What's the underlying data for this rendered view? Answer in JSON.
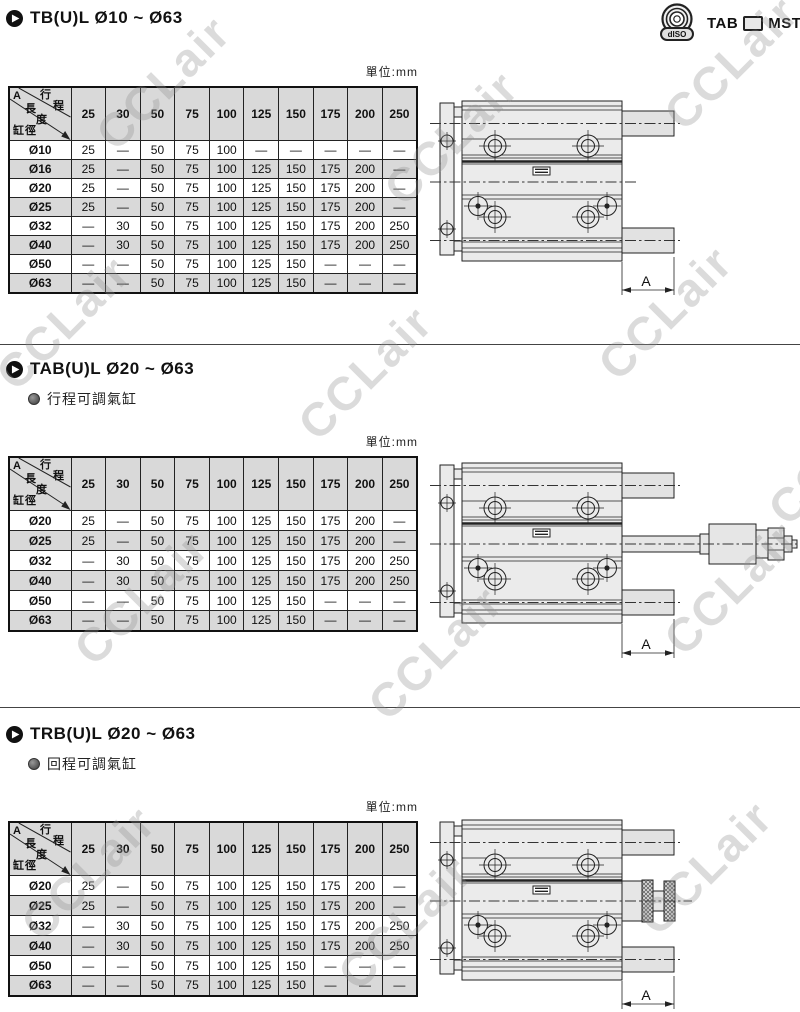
{
  "page": {
    "unit_label": "單位:mm",
    "watermark": "CCLair"
  },
  "badge": {
    "disc_text": "dISO",
    "left": "TAB",
    "right": "MST"
  },
  "corner_header": {
    "a": "A",
    "stroke": "行程",
    "length": "長度",
    "bore": "缸徑"
  },
  "columns": [
    "25",
    "30",
    "50",
    "75",
    "100",
    "125",
    "150",
    "175",
    "200",
    "250"
  ],
  "sections": [
    {
      "title": "TB(U)L  Ø10 ~ Ø63",
      "subtitle": "",
      "dim_label": "A",
      "rows": [
        {
          "bore": "Ø10",
          "values": [
            "25",
            "—",
            "50",
            "75",
            "100",
            "—",
            "—",
            "—",
            "—",
            "—"
          ]
        },
        {
          "bore": "Ø16",
          "values": [
            "25",
            "—",
            "50",
            "75",
            "100",
            "125",
            "150",
            "175",
            "200",
            "—"
          ]
        },
        {
          "bore": "Ø20",
          "values": [
            "25",
            "—",
            "50",
            "75",
            "100",
            "125",
            "150",
            "175",
            "200",
            "—"
          ]
        },
        {
          "bore": "Ø25",
          "values": [
            "25",
            "—",
            "50",
            "75",
            "100",
            "125",
            "150",
            "175",
            "200",
            "—"
          ]
        },
        {
          "bore": "Ø32",
          "values": [
            "—",
            "30",
            "50",
            "75",
            "100",
            "125",
            "150",
            "175",
            "200",
            "250"
          ]
        },
        {
          "bore": "Ø40",
          "values": [
            "—",
            "30",
            "50",
            "75",
            "100",
            "125",
            "150",
            "175",
            "200",
            "250"
          ]
        },
        {
          "bore": "Ø50",
          "values": [
            "—",
            "—",
            "50",
            "75",
            "100",
            "125",
            "150",
            "—",
            "—",
            "—"
          ]
        },
        {
          "bore": "Ø63",
          "values": [
            "—",
            "—",
            "50",
            "75",
            "100",
            "125",
            "150",
            "—",
            "—",
            "—"
          ]
        }
      ]
    },
    {
      "title": "TAB(U)L  Ø20 ~ Ø63",
      "subtitle": "行程可調氣缸",
      "dim_label": "A",
      "rows": [
        {
          "bore": "Ø20",
          "values": [
            "25",
            "—",
            "50",
            "75",
            "100",
            "125",
            "150",
            "175",
            "200",
            "—"
          ]
        },
        {
          "bore": "Ø25",
          "values": [
            "25",
            "—",
            "50",
            "75",
            "100",
            "125",
            "150",
            "175",
            "200",
            "—"
          ]
        },
        {
          "bore": "Ø32",
          "values": [
            "—",
            "30",
            "50",
            "75",
            "100",
            "125",
            "150",
            "175",
            "200",
            "250"
          ]
        },
        {
          "bore": "Ø40",
          "values": [
            "—",
            "30",
            "50",
            "75",
            "100",
            "125",
            "150",
            "175",
            "200",
            "250"
          ]
        },
        {
          "bore": "Ø50",
          "values": [
            "—",
            "—",
            "50",
            "75",
            "100",
            "125",
            "150",
            "—",
            "—",
            "—"
          ]
        },
        {
          "bore": "Ø63",
          "values": [
            "—",
            "—",
            "50",
            "75",
            "100",
            "125",
            "150",
            "—",
            "—",
            "—"
          ]
        }
      ]
    },
    {
      "title": "TRB(U)L  Ø20 ~ Ø63",
      "subtitle": "回程可調氣缸",
      "dim_label": "A",
      "rows": [
        {
          "bore": "Ø20",
          "values": [
            "25",
            "—",
            "50",
            "75",
            "100",
            "125",
            "150",
            "175",
            "200",
            "—"
          ]
        },
        {
          "bore": "Ø25",
          "values": [
            "25",
            "—",
            "50",
            "75",
            "100",
            "125",
            "150",
            "175",
            "200",
            "—"
          ]
        },
        {
          "bore": "Ø32",
          "values": [
            "—",
            "30",
            "50",
            "75",
            "100",
            "125",
            "150",
            "175",
            "200",
            "250"
          ]
        },
        {
          "bore": "Ø40",
          "values": [
            "—",
            "30",
            "50",
            "75",
            "100",
            "125",
            "150",
            "175",
            "200",
            "250"
          ]
        },
        {
          "bore": "Ø50",
          "values": [
            "—",
            "—",
            "50",
            "75",
            "100",
            "125",
            "150",
            "—",
            "—",
            "—"
          ]
        },
        {
          "bore": "Ø63",
          "values": [
            "—",
            "—",
            "50",
            "75",
            "100",
            "125",
            "150",
            "—",
            "—",
            "—"
          ]
        }
      ]
    }
  ]
}
